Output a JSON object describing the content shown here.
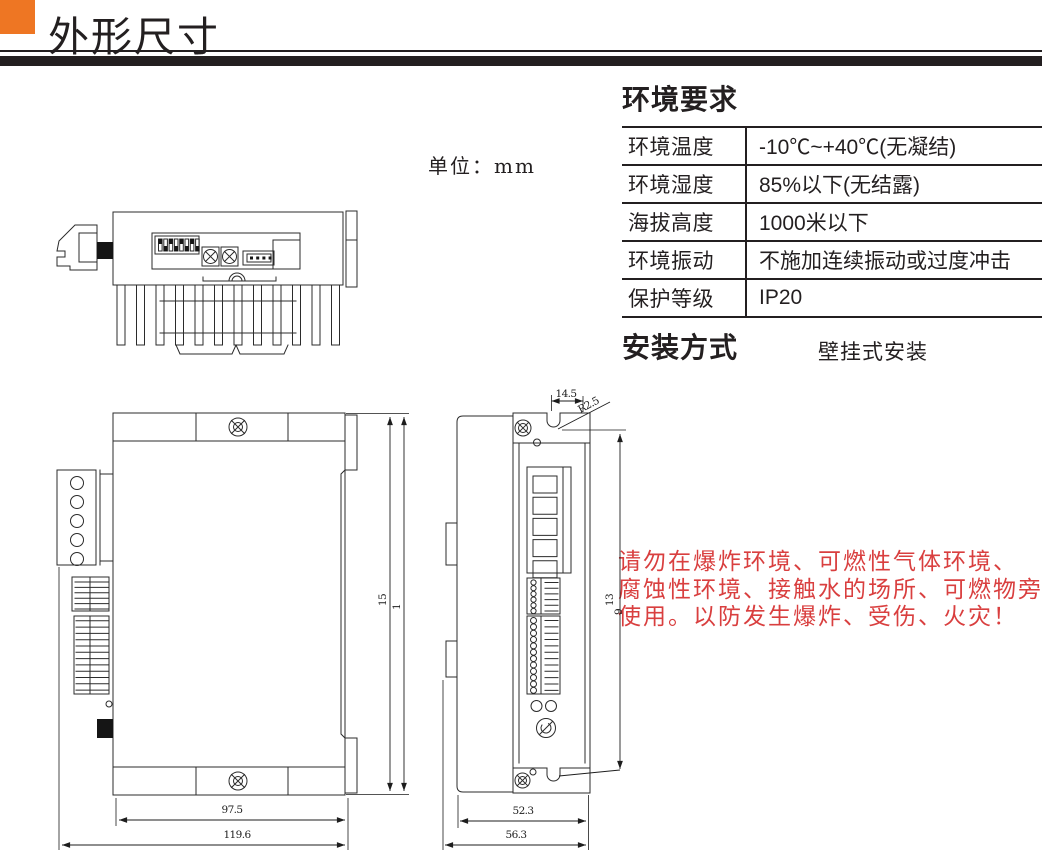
{
  "page": {
    "title": "外形尺寸",
    "unit_label": "单位：mm"
  },
  "environment": {
    "title": "环境要求",
    "rows": [
      {
        "label": "环境温度",
        "value": "-10℃~+40℃(无凝结)"
      },
      {
        "label": "环境湿度",
        "value": "85%以下(无结露)"
      },
      {
        "label": "海拔高度",
        "value": "1000米以下"
      },
      {
        "label": "环境振动",
        "value": "不施加连续振动或过度冲击"
      },
      {
        "label": "保护等级",
        "value": "IP20"
      }
    ]
  },
  "installation": {
    "title": "安装方式",
    "value": "壁挂式安装"
  },
  "warning": {
    "lines": [
      "请勿在爆炸环境、可燃性气体环境、",
      "腐蚀性环境、接触水的场所、可燃物旁",
      "使用。以防发生爆炸、受伤、火灾！"
    ]
  },
  "dimensions": {
    "side_view": {
      "body_width": "97.5",
      "total_width": "119.6",
      "height_a": "15",
      "height_b": "1"
    },
    "front_view": {
      "notch_offset": "14.5",
      "radius": "R2.5",
      "height_a": "13",
      "height_b": "9",
      "inner_width": "52.3",
      "total_width": "56.3"
    }
  },
  "colors": {
    "accent_orange": "#EE7623",
    "warning_red": "#D93F3F",
    "line_black": "#231f20"
  }
}
